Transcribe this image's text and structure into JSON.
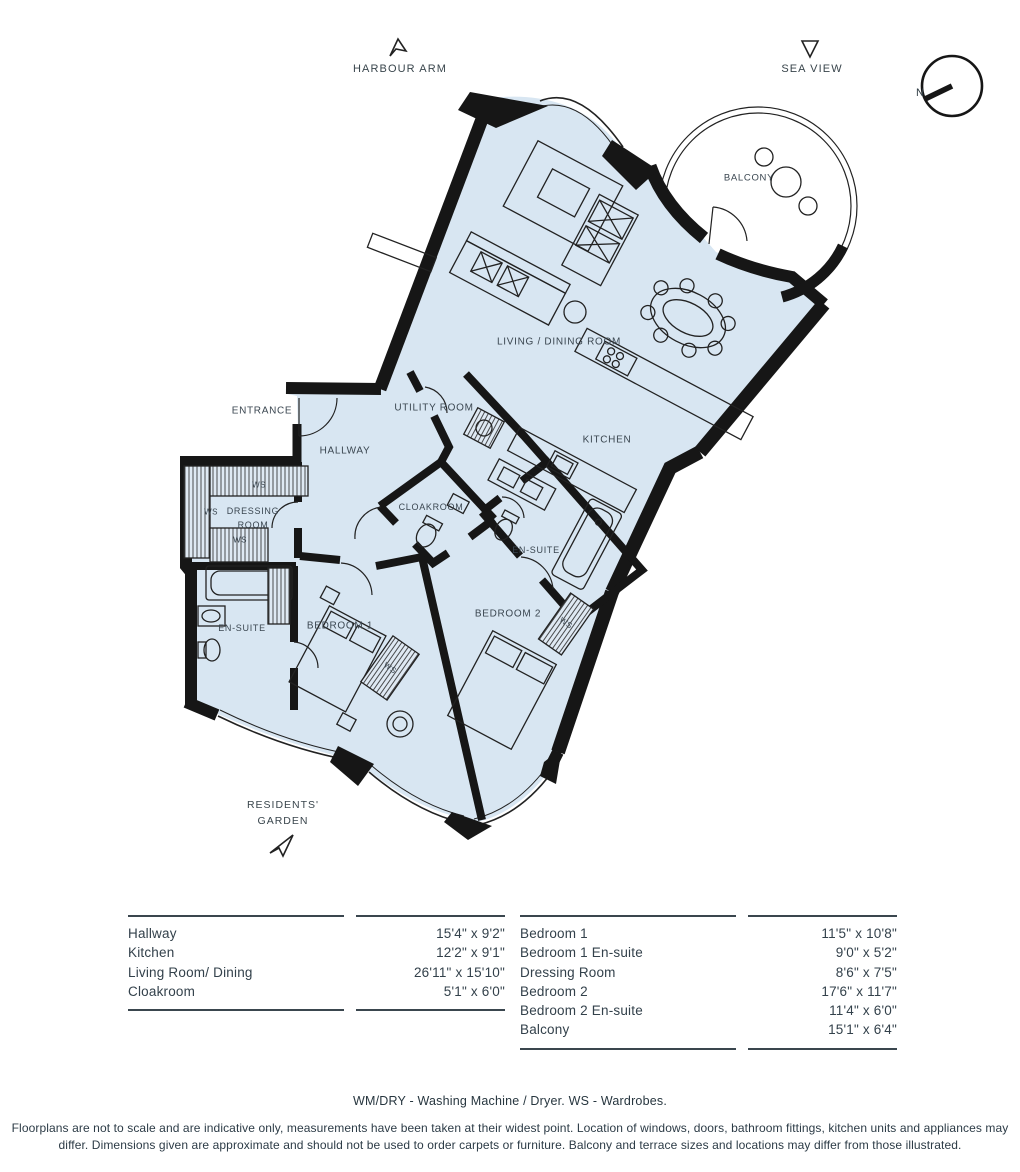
{
  "header": {
    "harbour_arm": "HARBOUR ARM",
    "sea_view": "SEA VIEW",
    "compass_north": "N"
  },
  "garden": {
    "line1": "RESIDENTS'",
    "line2": "GARDEN"
  },
  "plan": {
    "labels": {
      "living": "LIVING / DINING ROOM",
      "balcony": "BALCONY",
      "kitchen": "KITCHEN",
      "utility": "UTILITY ROOM",
      "hallway": "HALLWAY",
      "entrance": "ENTRANCE",
      "cloakroom": "CLOAKROOM",
      "ensuite": "EN-SUITE",
      "bedroom1": "BEDROOM 1",
      "bedroom2": "BEDROOM 2",
      "dressing1": "DRESSING",
      "dressing2": "ROOM",
      "ws": "WS"
    },
    "colors": {
      "floor_fill": "#d8e6f2",
      "wall": "#161616",
      "label_text": "#3a4650"
    }
  },
  "tables": {
    "left": {
      "rows": [
        {
          "name": "Hallway",
          "size": "15'4\" x 9'2\""
        },
        {
          "name": "Kitchen",
          "size": "12'2\" x 9'1\""
        },
        {
          "name": "Living Room/ Dining",
          "size": "26'11\" x 15'10\""
        },
        {
          "name": "Cloakroom",
          "size": "5'1\" x 6'0\""
        }
      ]
    },
    "right": {
      "rows": [
        {
          "name": "Bedroom 1",
          "size": "11'5\" x 10'8\""
        },
        {
          "name": "Bedroom 1 En-suite",
          "size": "9'0\" x 5'2\""
        },
        {
          "name": "Dressing Room",
          "size": "8'6\" x 7'5\""
        },
        {
          "name": "Bedroom 2",
          "size": "17'6\" x 11'7\""
        },
        {
          "name": "Bedroom 2 En-suite",
          "size": "11'4\" x 6'0\""
        },
        {
          "name": "Balcony",
          "size": "15'1\" x 6'4\""
        }
      ]
    }
  },
  "footer": {
    "legend": "WM/DRY - Washing Machine / Dryer. WS - Wardrobes.",
    "disclaimer1": "Floorplans are not to scale and are indicative only, measurements have been taken at their widest point. Location of windows, doors, bathroom fittings, kitchen units and appliances may",
    "disclaimer2": "differ. Dimensions given are approximate and should not be used to order carpets or furniture. Balcony and terrace sizes and locations may differ from those illustrated."
  }
}
